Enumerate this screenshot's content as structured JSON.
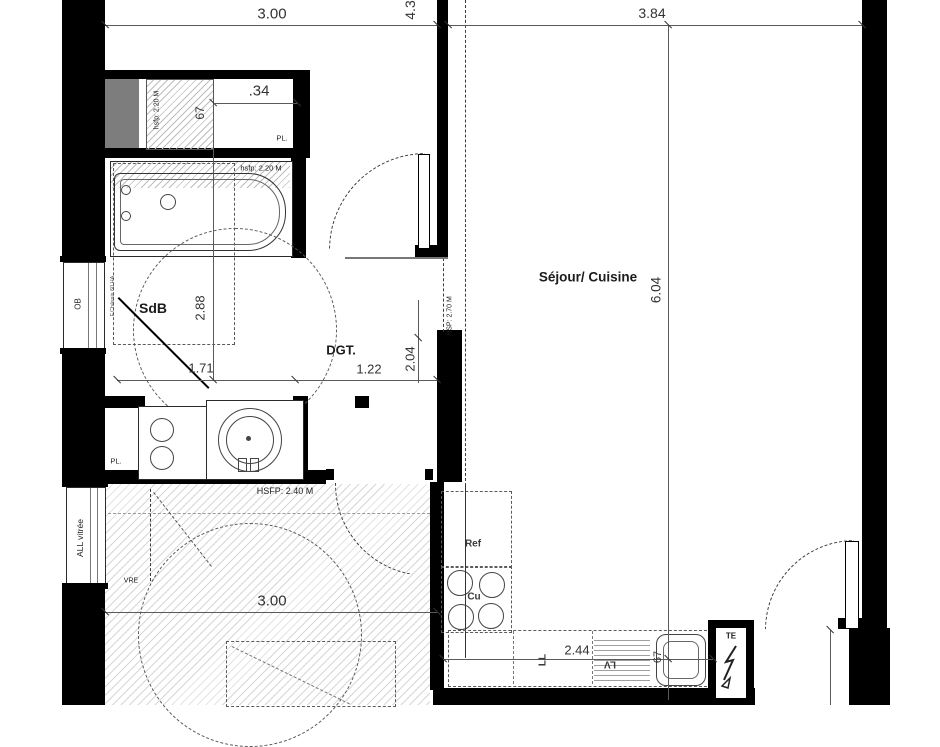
{
  "plan_title": "apartment-floor-plan",
  "rooms": {
    "sdb": "SdB",
    "dgt": "DGT.",
    "sejour": "Séjour/ Cuisine"
  },
  "dims": {
    "top_width_left": "3.00",
    "top_width_right": "3.84",
    "top_vertical": "4.3",
    "sejour_depth": "6.04",
    "sdb_depth": "2.88",
    "sdb_width": "1.71",
    "dgt_width": "1.22",
    "dgt_depth": "2.04",
    "closet_width": ".34",
    "closet_depth": "67",
    "bottom_room_width": "3.00",
    "kitchen_length": "2.44",
    "sink_width": "67"
  },
  "heights": {
    "closet": "hsfp: 2.20 M",
    "bath": "hsfp: 2.20 M",
    "sejour": "HSP: 2.70 M",
    "bottom_zone": "HSFP: 2.40 M"
  },
  "annotations": {
    "ob_window": "OB",
    "glazed_wall": "ALL vitrée",
    "shutter": "VRE",
    "closet_top": "PL.",
    "closet_bottom": "PL.",
    "window_note": "F.Châssis 60 HA",
    "electrical_panel": "TE",
    "fridge": "Ref",
    "cooktop": "Cu",
    "washer": "LL",
    "dishwasher": "LV"
  },
  "colors": {
    "wall": "#000000",
    "duct": "#7d7d7d",
    "dimension": "#5a5a5a",
    "hatch": "#d7d7d7",
    "dashed": "#3a3a3a"
  }
}
